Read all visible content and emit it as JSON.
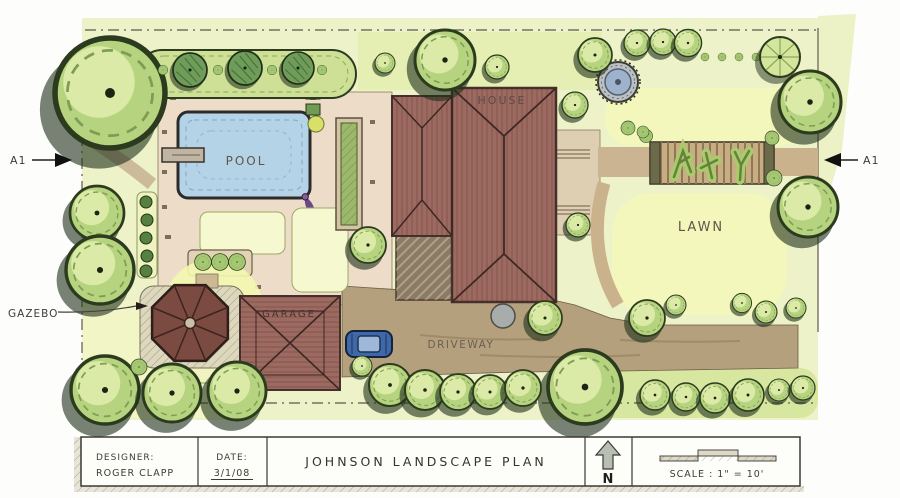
{
  "plan": {
    "labels": {
      "pool": "POOL",
      "house": "HOUSE",
      "lawn": "LAWN",
      "garage": "GARAGE",
      "driveway": "DRIVEWAY",
      "gazebo": "GAZEBO"
    },
    "section_markers": {
      "left": "A1",
      "right": "A1"
    }
  },
  "title_block": {
    "designer_label": "DESIGNER:",
    "designer_name": "ROGER CLAPP",
    "date_label": "DATE:",
    "date_value": "3/1/08",
    "title": "JOHNSON LANDSCAPE PLAN",
    "north_label": "N",
    "scale_label": "SCALE : 1\" = 10'"
  },
  "colors": {
    "lawn": "#edf2c8",
    "lawn_bright": "#f5f7c0",
    "canopy": "#b6d37f",
    "canopy_dark": "#6f9c58",
    "roof": "#9d6a61",
    "roof_dark": "#7b4a40",
    "pool_water": "#b5d3e7",
    "deck": "#ecdcc8",
    "driveway": "#b4a07d",
    "path": "#c9b28c",
    "ink": "#2e2a22"
  }
}
